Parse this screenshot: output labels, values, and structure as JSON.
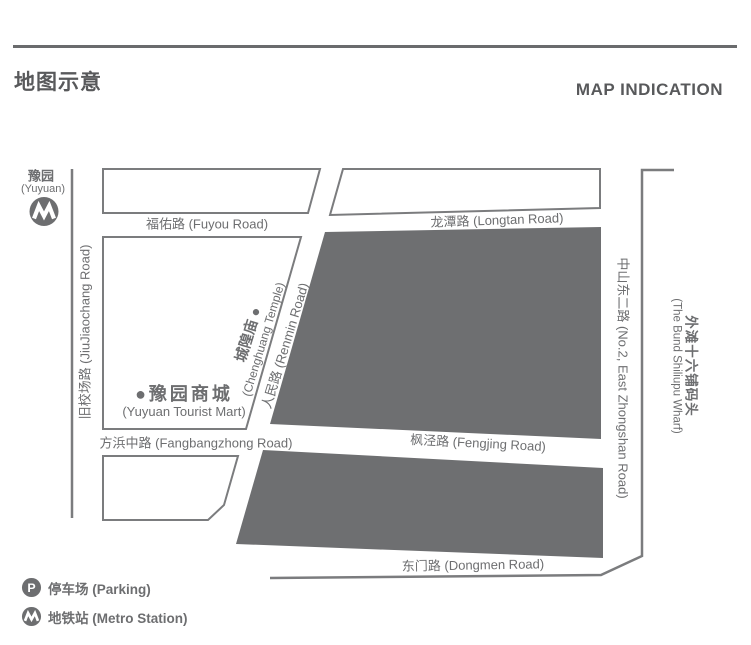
{
  "page": {
    "title_cn": "地图示意",
    "title_en": "MAP INDICATION"
  },
  "colors": {
    "ink": "#6d6e70",
    "line": "#7b7c7e",
    "block_dark": "#6e6f71",
    "title": "#58595b",
    "white": "#ffffff"
  },
  "map": {
    "station": {
      "cn": "豫园",
      "en": "(Yuyuan)"
    },
    "roads": {
      "fuyou": "福佑路 (Fuyou Road)",
      "longtan": "龙潭路 (Longtan Road)",
      "jiujiaochang": "旧校场路 (JiuJiaochang Road)",
      "renmin": "人民路 (Renmin Road)",
      "fangbangzhong": "方浜中路 (Fangbangzhong Road)",
      "fengjing": "枫泾路 (Fengjing Road)",
      "dongmen": "东门路 (Dongmen Road)",
      "zhongshan": "中山东二路 (No.2, East Zhongshan Road)"
    },
    "pois": {
      "chenghuang": {
        "cn": "城隍庙 ●",
        "en": "(Chenghuang Temple)"
      },
      "yuyuan_mart": {
        "cn": "●豫园商城",
        "en": "(Yuyuan Tourist Mart)"
      },
      "wharf": {
        "cn": "外滩十六铺码头",
        "en": "(The Bund Shiliupu Wharf)"
      }
    }
  },
  "legend": {
    "parking": {
      "icon_letter": "P",
      "label": "停车场 (Parking)"
    },
    "metro": {
      "label": "地铁站 (Metro Station)"
    }
  }
}
